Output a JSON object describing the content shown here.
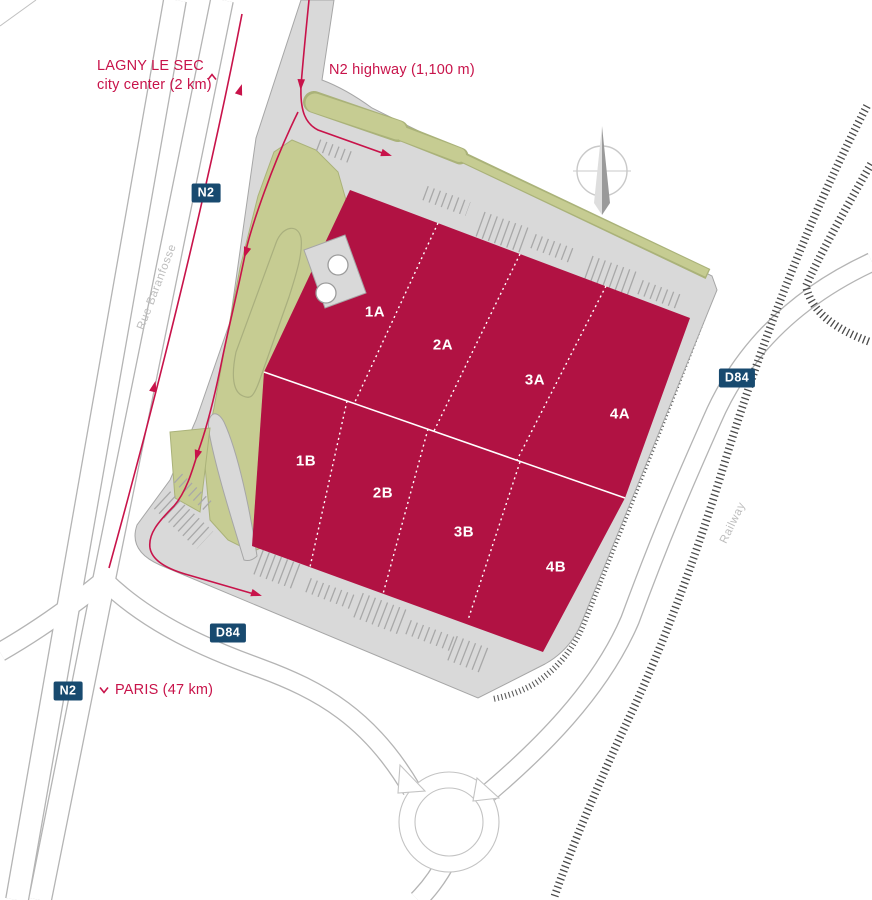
{
  "labels": {
    "lagny_line1": "LAGNY LE SEC",
    "lagny_line2": "city center (2 km)",
    "n2_highway": "N2 highway (1,100 m)",
    "paris": "PARIS (47 km)",
    "street": "Rue Baranfosse",
    "railway": "Railway"
  },
  "badges": {
    "n2_top": "N2",
    "n2_bottom": "N2",
    "d84_left": "D84",
    "d84_right": "D84"
  },
  "building": {
    "units": [
      "1A",
      "2A",
      "3A",
      "4A",
      "1B",
      "2B",
      "3B",
      "4B"
    ]
  },
  "colors": {
    "building": "#b11243",
    "route": "#c8134a",
    "badge_bg": "#184a6f",
    "badge_text": "#ffffff",
    "site_gray": "#d9d9d9",
    "green": "#c6cc92",
    "railway": "#4a4a4a",
    "gray_text": "#bdbdbd"
  }
}
